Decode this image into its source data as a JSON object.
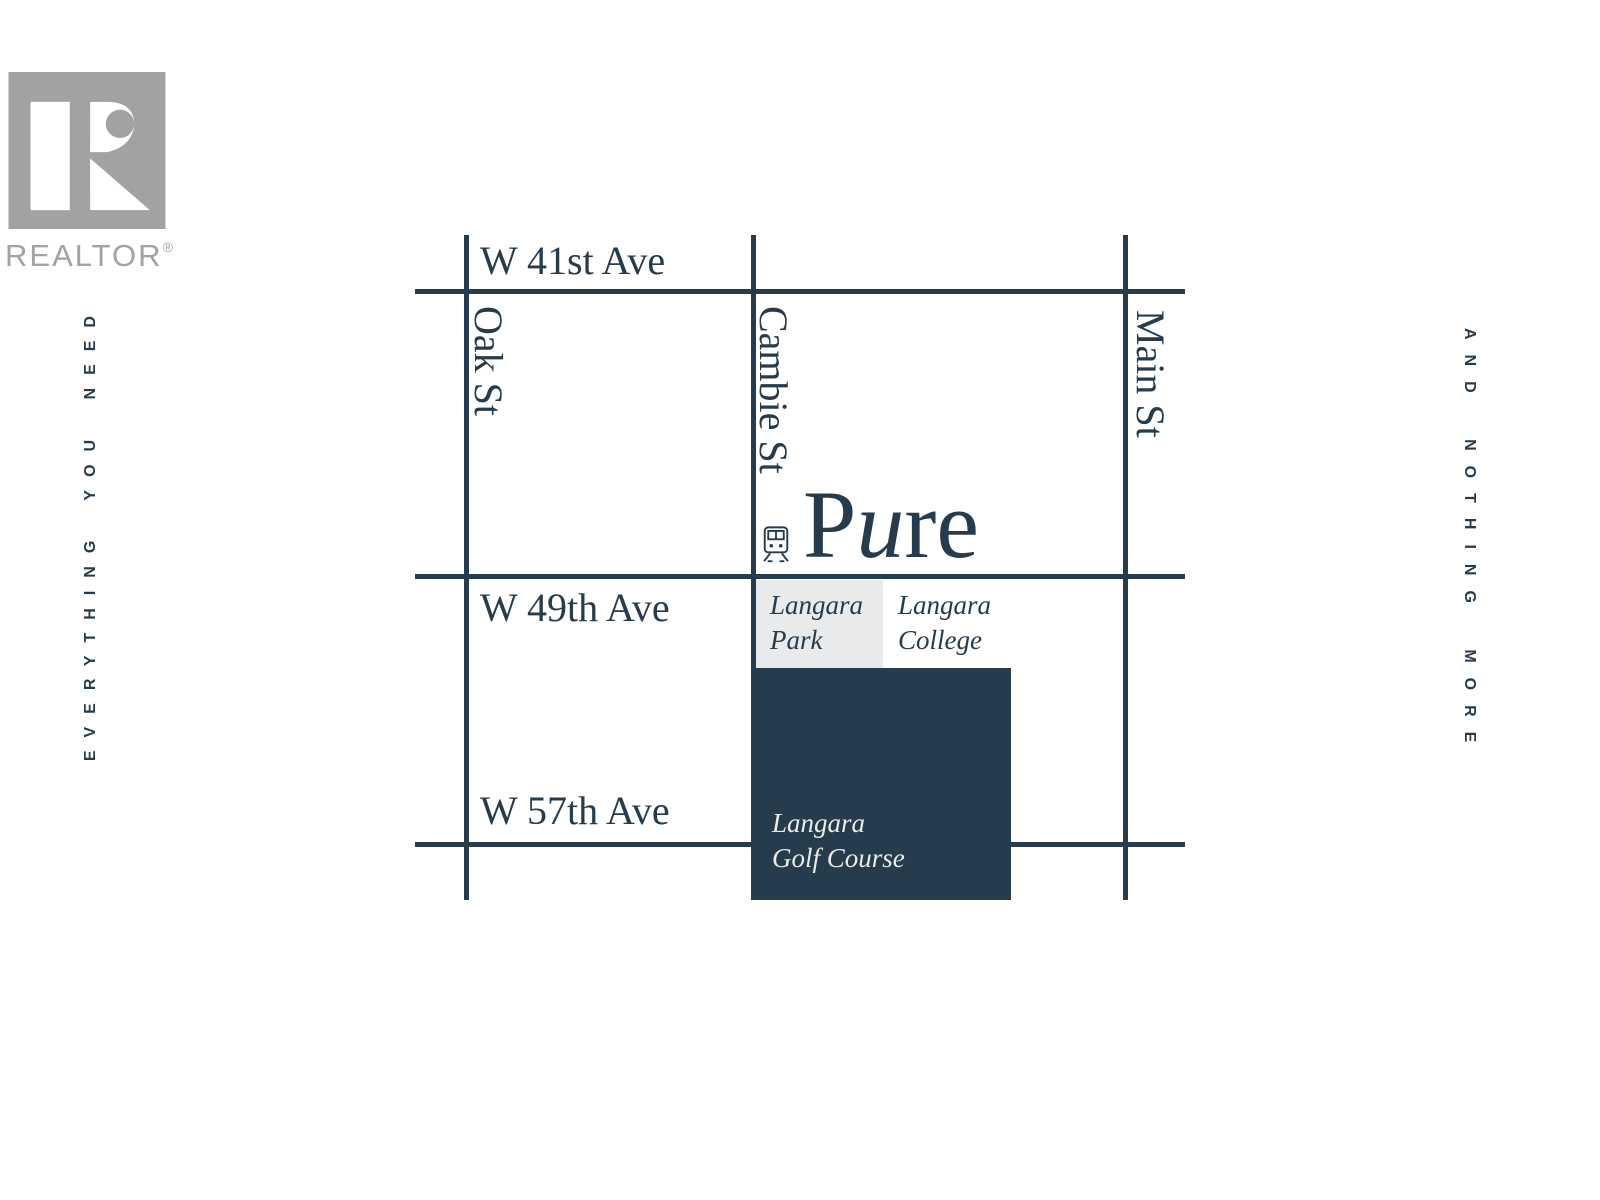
{
  "branding": {
    "realtor_wordmark": "REALTOR",
    "registered_mark": "®"
  },
  "taglines": {
    "left": "EVERYTHING YOU NEED",
    "right": "AND NOTHING MORE"
  },
  "wordmark": {
    "full": "Pure",
    "part1": "P",
    "part_italic": "u",
    "part2": "re"
  },
  "map": {
    "horizontal_streets": [
      "W 41st Ave",
      "W 49th Ave",
      "W 57th Ave"
    ],
    "vertical_streets": [
      "Oak St",
      "Cambie St",
      "Main St"
    ],
    "places": {
      "park": {
        "line1": "Langara",
        "line2": "Park"
      },
      "college": {
        "line1": "Langara",
        "line2": "College"
      },
      "golf": {
        "line1": "Langara",
        "line2": "Golf Course"
      }
    },
    "icons": {
      "station": "train-station-icon"
    }
  },
  "colors": {
    "navy": "#263B4C",
    "park_gray": "#E9EAEB",
    "logo_gray": "#A2A2A2",
    "golf_label_text": "#E9EDE7",
    "background": "#FFFFFF"
  }
}
